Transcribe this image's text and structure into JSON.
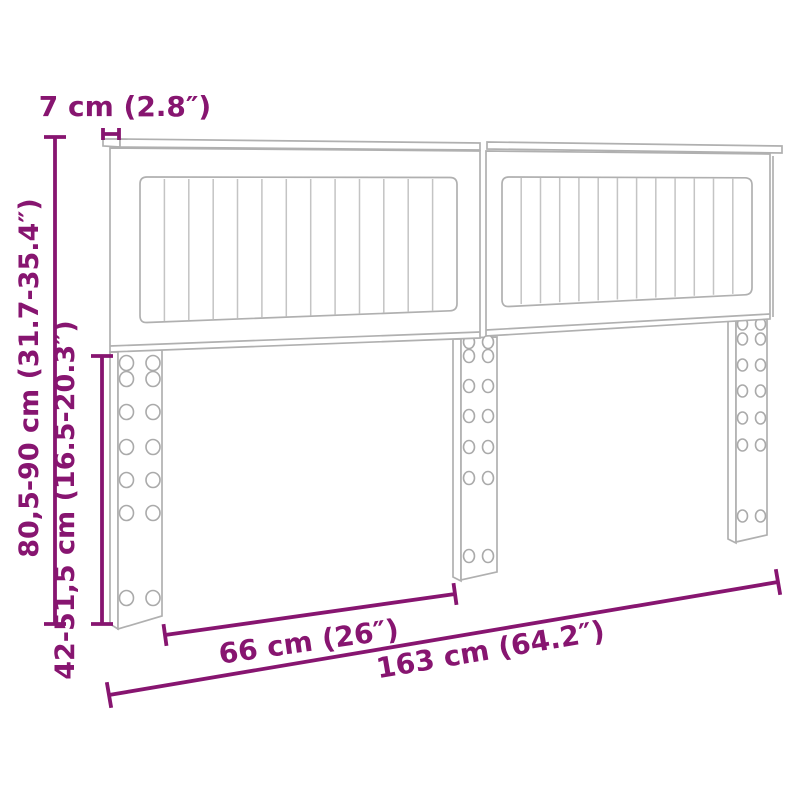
{
  "diagram": {
    "kind": "furniture-dimension-drawing",
    "dimensions": {
      "top_rail_depth": "7 cm (2.8″)",
      "total_height_range": "80,5-90 cm (31.7-35.4″)",
      "leg_height_range": "42-51,5 cm (16.5-20.3″)",
      "inner_leg_span": "66 cm (26″)",
      "total_width": "163 cm (64.2″)"
    },
    "figure": {
      "panel_count": 2,
      "slat_lines_per_panel": 12,
      "leg_count": 3,
      "hole_columns_per_leg": 2,
      "hole_rows_per_leg": 7
    },
    "colors": {
      "dimension": "#871570",
      "outline": "#b0b0b0",
      "slat": "#c4c4c4",
      "background": "#ffffff"
    }
  }
}
